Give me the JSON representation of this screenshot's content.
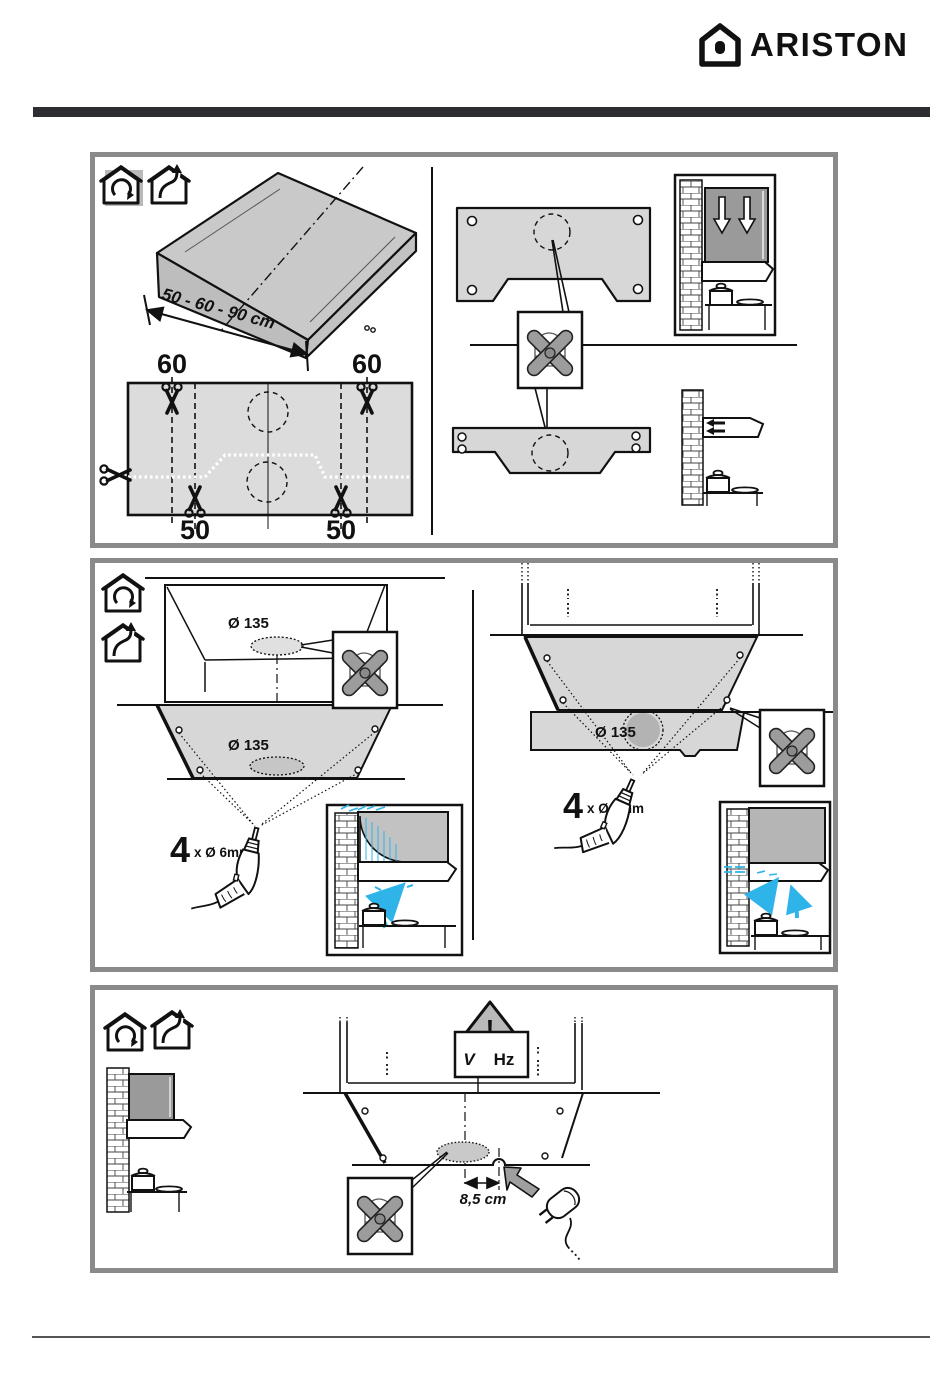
{
  "header": {
    "brand": "ARISTON"
  },
  "panel1": {
    "dim_label": "50 - 60 - 90 cm",
    "cut_top_left": "60",
    "cut_top_right": "60",
    "cut_bottom_left": "50",
    "cut_bottom_right": "50"
  },
  "panel2": {
    "hole_label_cabinet": "Ø 135",
    "hole_label_template": "Ø 135",
    "hole_label_wall": "Ø 135",
    "drill_count_left": "4",
    "drill_size_left": "x Ø 6mm",
    "drill_count_right": "4",
    "drill_size_right": "x Ø 6mm"
  },
  "panel3": {
    "warning_mark": "!",
    "voltage_unit": "V",
    "frequency_unit": "Hz",
    "cable_distance": "8,5 cm"
  },
  "colors": {
    "accent_blue": "#2fb4e9",
    "panel_border": "#8a8a8a",
    "template_fill": "#d8d8d8",
    "cabinet_fill": "#9a9a9a"
  }
}
